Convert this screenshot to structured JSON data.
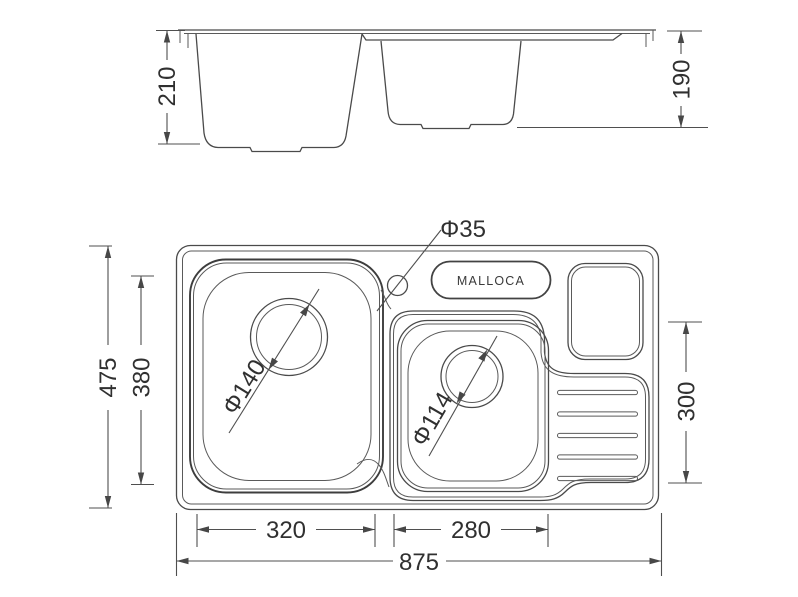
{
  "drawing": {
    "brand": {
      "logo": "MALLOCA"
    },
    "elevation_view": {
      "depth_left_bowl": "210",
      "depth_right_bowl": "190"
    },
    "plan_view": {
      "overall_width": "875",
      "overall_depth": "475",
      "left_bowl_depth": "380",
      "right_section_depth": "300",
      "left_bowl_width": "320",
      "right_bowl_width": "280",
      "faucet_hole_diameter": "Φ35",
      "left_drain_diameter": "Φ140",
      "right_drain_diameter": "Φ114"
    },
    "colors": {
      "line": "#4a4a4a",
      "text": "#303030",
      "background": "#ffffff"
    }
  }
}
